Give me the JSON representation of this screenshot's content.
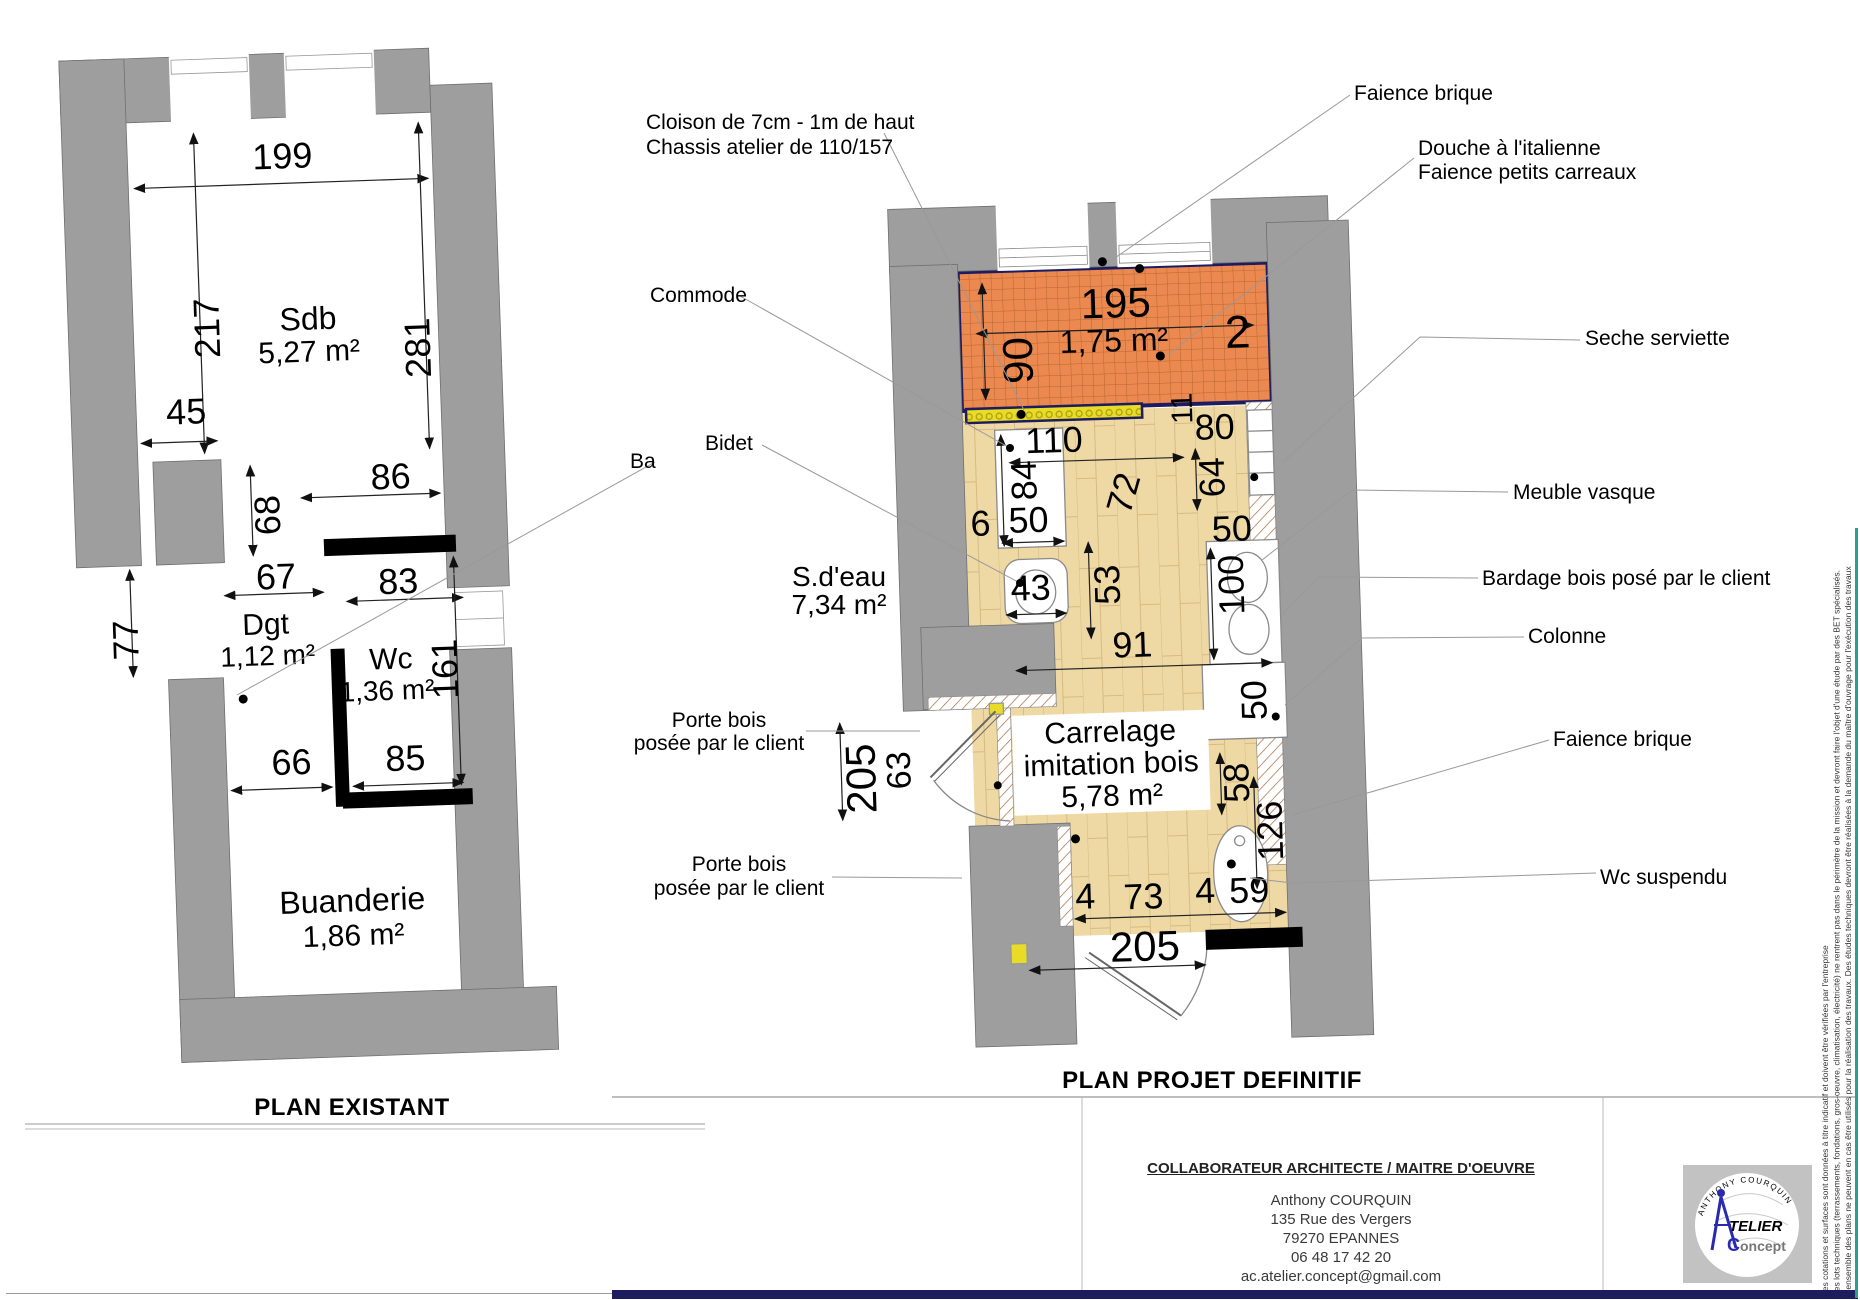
{
  "colors": {
    "wall_gray": "#9e9e9e",
    "tile_orange": "#ec8950",
    "tile_grid": "#b5672f",
    "floor_beige": "#eed9a4",
    "navy": "#1c1c5e",
    "yellow_cloison": "#e8dc26",
    "teal_edge": "#2e9c96",
    "logo_blue": "#2a2ab0"
  },
  "titles": {
    "existant": "PLAN EXISTANT",
    "projet": "PLAN PROJET DEFINITIF"
  },
  "plan_existant": {
    "rooms": {
      "sdb_name": "Sdb",
      "sdb_area": "5,27 m²",
      "dgt_name": "Dgt",
      "dgt_area": "1,12 m²",
      "wc_name": "Wc",
      "wc_area": "1,36 m²",
      "buanderie_name": "Buanderie",
      "buanderie_area": "1,86 m²"
    },
    "dims": {
      "d199": "199",
      "d217": "217",
      "d281": "281",
      "d45": "45",
      "d68": "68",
      "d86": "86",
      "d67": "67",
      "d83": "83",
      "d77": "77",
      "d161": "161",
      "d66": "66",
      "d85": "85"
    }
  },
  "plan_projet": {
    "rooms": {
      "sdeau_name": "S.d'eau",
      "sdeau_area": "7,34 m²",
      "douche_area": "1,75 m²",
      "floor_l1": "Carrelage",
      "floor_l2": "imitation bois",
      "floor_area": "5,78 m²"
    },
    "dims": {
      "d195": "195",
      "d90": "90",
      "d2": "2",
      "d11": "11",
      "d110": "110",
      "d84": "84",
      "d6": "6",
      "d50_commode": "50",
      "d80": "80",
      "d64": "64",
      "d72": "72",
      "d43": "43",
      "d53": "53",
      "d100": "100",
      "d50_vasque": "50",
      "d91": "91",
      "d50_colonne": "50",
      "d58": "58",
      "d126": "126",
      "d63": "63",
      "d205_porte": "205",
      "d4a": "4",
      "d73": "73",
      "d4b": "4",
      "d59": "59",
      "d205_bas": "205"
    }
  },
  "callouts": {
    "cloison_l1": "Cloison de 7cm - 1m de haut",
    "cloison_l2": "Chassis atelier de 110/157",
    "commode": "Commode",
    "ba": "Ba",
    "bidet": "Bidet",
    "porte1_l1": "Porte bois",
    "porte1_l2": "posée par le client",
    "porte2_l1": "Porte bois",
    "porte2_l2": "posée par le client",
    "faience_haut": "Faience brique",
    "douche_l1": "Douche à l'italienne",
    "douche_l2": "Faience petits carreaux",
    "seche": "Seche serviette",
    "meuble": "Meuble vasque",
    "bardage": "Bardage bois posé par le client",
    "colonne": "Colonne",
    "faience_bas": "Faience brique",
    "wc_suspendu": "Wc suspendu"
  },
  "title_block": {
    "header": "COLLABORATEUR ARCHITECTE / MAITRE D'OEUVRE",
    "name": "Anthony COURQUIN",
    "address1": "135 Rue des Vergers",
    "address2": "79270 EPANNES",
    "phone": "06 48 17 42 20",
    "email": "ac.atelier.concept@gmail.com"
  },
  "logo": {
    "arc_text": "ANTHONY COURQUIN",
    "atelier": "TELIER",
    "concept_c": "C",
    "concept_rest": "oncept"
  },
  "disclaimers": {
    "l1": "Les cotations et surfaces sont données à titre indicatif et doivent être vérifiées par l'entreprise",
    "l2": "Les lots techniques (terrassements, fondations, gros-oeuvre, climatisation, électricité) ne rentrent pas dans le périmètre de la mission et devront faire l'objet d'une étude par des BET spécialisés.",
    "l3": "L'ensemble des plans ne peuvent en cas être utilisés pour la réalisation des travaux. Des études techniques devront être réalisées à la demande du maître d'ouvrage pour l'exécution des travaux"
  }
}
